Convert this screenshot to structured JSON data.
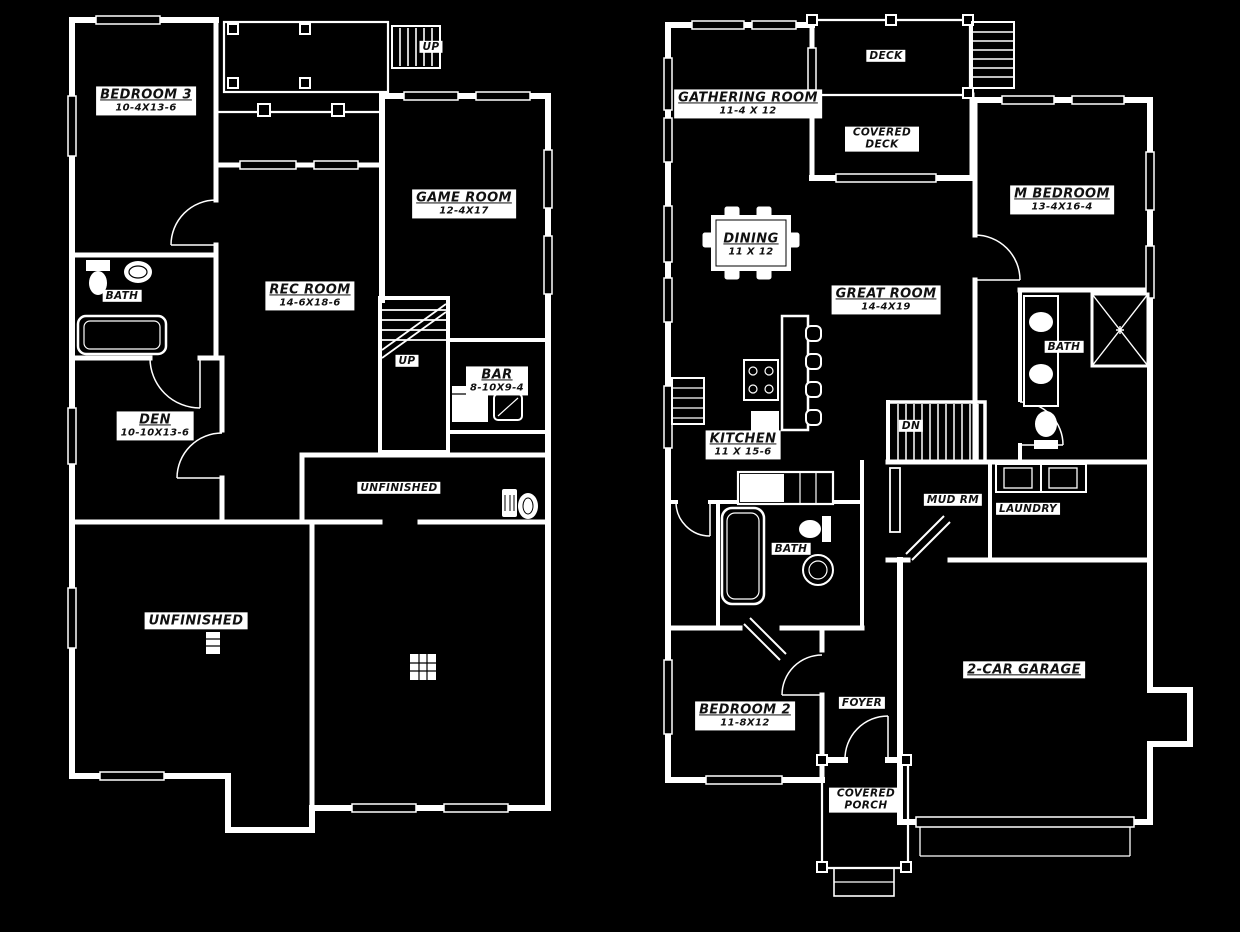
{
  "document": {
    "type": "floor-plan",
    "views": [
      "lower-level",
      "main-level"
    ]
  },
  "colors": {
    "background": "#000000",
    "walls": "#ffffff",
    "label_background": "#ffffff",
    "label_text": "#101010"
  },
  "left_plan": {
    "title": "lower-level",
    "rooms": [
      {
        "name": "BEDROOM 3",
        "dims": "10-4X13-6"
      },
      {
        "name": "GAME ROOM",
        "dims": "12-4X17"
      },
      {
        "name": "REC ROOM",
        "dims": "14-6X18-6"
      },
      {
        "name": "BATH"
      },
      {
        "name": "DEN",
        "dims": "10-10X13-6"
      },
      {
        "name": "BAR",
        "dims": "8-10X9-4"
      },
      {
        "name": "UNFINISHED"
      },
      {
        "name": "UNFINISHED"
      }
    ],
    "stairs": [
      {
        "label": "UP"
      },
      {
        "label": "UP"
      }
    ]
  },
  "right_plan": {
    "title": "main-level",
    "rooms": [
      {
        "name": "GATHERING ROOM",
        "dims": "11-4 X 12"
      },
      {
        "name": "DECK"
      },
      {
        "name": "COVERED DECK"
      },
      {
        "name": "M BEDROOM",
        "dims": "13-4X16-4"
      },
      {
        "name": "DINING",
        "dims": "11 X 12"
      },
      {
        "name": "GREAT ROOM",
        "dims": "14-4X19"
      },
      {
        "name": "BATH"
      },
      {
        "name": "KITCHEN",
        "dims": "11 X 15-6"
      },
      {
        "name": "MUD RM"
      },
      {
        "name": "LAUNDRY"
      },
      {
        "name": "BATH"
      },
      {
        "name": "BEDROOM 2",
        "dims": "11-8X12"
      },
      {
        "name": "FOYER"
      },
      {
        "name": "2-CAR GARAGE"
      },
      {
        "name": "COVERED PORCH"
      }
    ],
    "stairs": [
      {
        "label": "DN"
      }
    ]
  },
  "fixtures": [
    "toilet-icon",
    "pedestal-sink-icon",
    "vanity-sink-icon",
    "bathtub-icon",
    "shower-icon",
    "washer-icon",
    "dryer-icon",
    "dining-table-icon",
    "chair-icon",
    "kitchen-island-icon",
    "bar-stool-icon",
    "range-icon",
    "pantry-shelves-icon",
    "dishwasher-icon",
    "kitchen-counter-icon",
    "stairs-icon",
    "deck-post-icon",
    "furnace-icon",
    "water-heater-icon",
    "support-column-icon",
    "door-swing-icon",
    "window-icon",
    "garage-door-icon"
  ]
}
